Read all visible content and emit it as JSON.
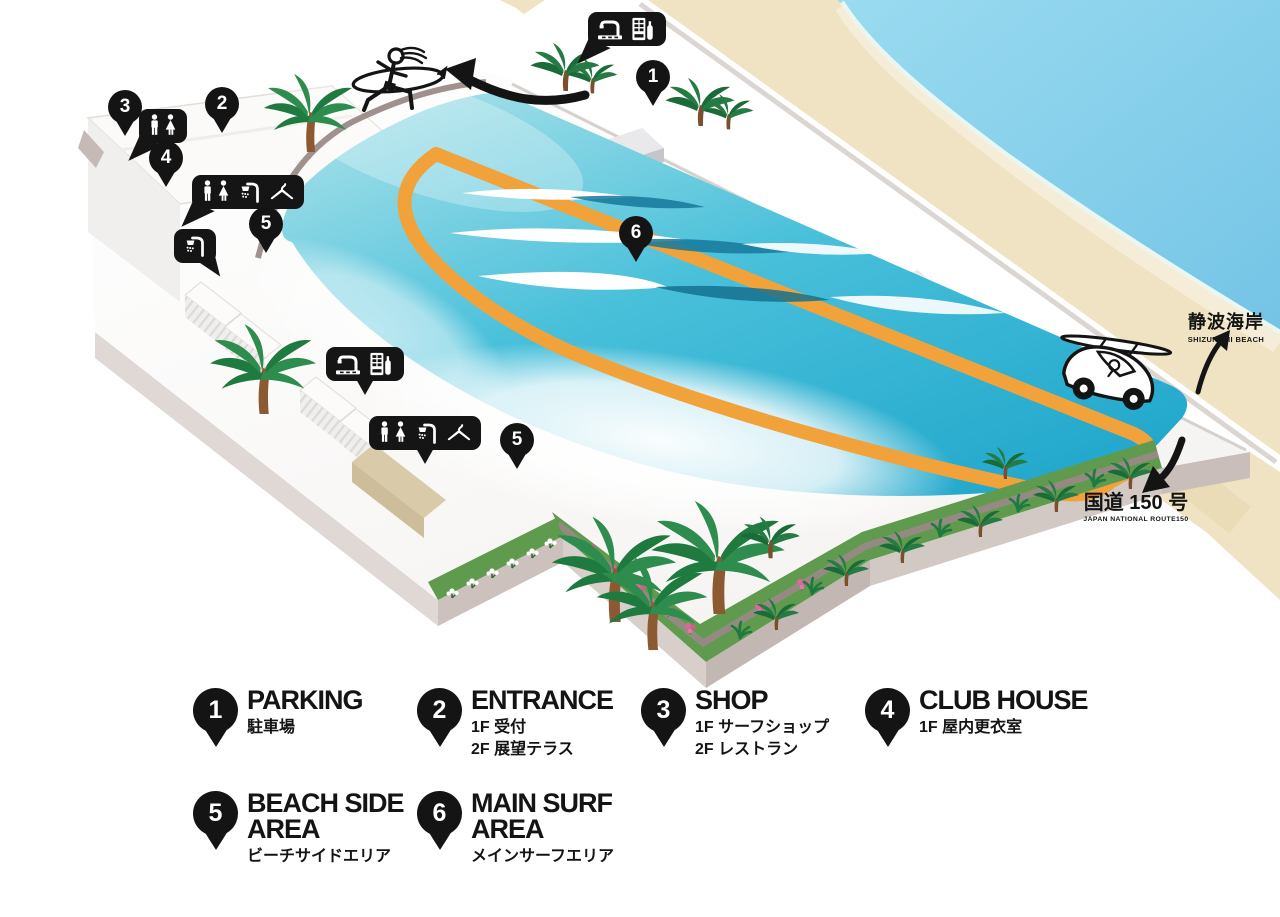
{
  "map": {
    "labels": {
      "beach": {
        "jp": "静波海岸",
        "en": "SHIZUNAMI BEACH"
      },
      "route": {
        "jp": "国道 150 号",
        "en": "JAPAN NATIONAL ROUTE150"
      }
    },
    "pins": [
      {
        "number": "1",
        "x": 653,
        "y": 77
      },
      {
        "number": "2",
        "x": 222,
        "y": 104
      },
      {
        "number": "3",
        "x": 125,
        "y": 107
      },
      {
        "number": "4",
        "x": 166,
        "y": 158
      },
      {
        "number": "5",
        "x": 266,
        "y": 224
      },
      {
        "number": "5",
        "x": 517,
        "y": 440
      },
      {
        "number": "6",
        "x": 636,
        "y": 233
      }
    ],
    "amenity_bubbles": [
      {
        "x": 163,
        "y": 126,
        "icons": [
          "restroom"
        ],
        "tail": "down-left"
      },
      {
        "x": 248,
        "y": 192,
        "icons": [
          "restroom",
          "shower",
          "hanger"
        ],
        "tail": "down-left"
      },
      {
        "x": 195,
        "y": 246,
        "icons": [
          "shower"
        ],
        "tail": "down-right"
      },
      {
        "x": 365,
        "y": 364,
        "icons": [
          "foot-shower",
          "vending-machine"
        ],
        "tail": "down"
      },
      {
        "x": 425,
        "y": 433,
        "icons": [
          "restroom",
          "shower",
          "hanger"
        ],
        "tail": "down"
      },
      {
        "x": 627,
        "y": 29,
        "icons": [
          "foot-shower",
          "vending-machine"
        ],
        "tail": "down-left"
      }
    ]
  },
  "legend": {
    "items": [
      {
        "number": "1",
        "title": [
          "PARKING"
        ],
        "sub": [
          "駐車場"
        ]
      },
      {
        "number": "2",
        "title": [
          "ENTRANCE"
        ],
        "sub": [
          "1F 受付",
          "2F 展望テラス"
        ]
      },
      {
        "number": "3",
        "title": [
          "SHOP"
        ],
        "sub": [
          "1F サーフショップ",
          "2F レストラン"
        ]
      },
      {
        "number": "4",
        "title": [
          "CLUB HOUSE"
        ],
        "sub": [
          "1F 屋内更衣室"
        ]
      },
      {
        "number": "5",
        "title": [
          "BEACH SIDE",
          "AREA"
        ],
        "sub": [
          "ビーチサイドエリア"
        ]
      },
      {
        "number": "6",
        "title": [
          "MAIN SURF",
          "AREA"
        ],
        "sub": [
          "メインサーフエリア"
        ]
      }
    ]
  },
  "colors": {
    "accent_black": "#151515",
    "track_orange": "#F2A23B",
    "water_teal": "#35B9D6",
    "sand": "#EFE3C4",
    "ocean": "#84CDE9",
    "garden_green": "#5F9A4E"
  }
}
